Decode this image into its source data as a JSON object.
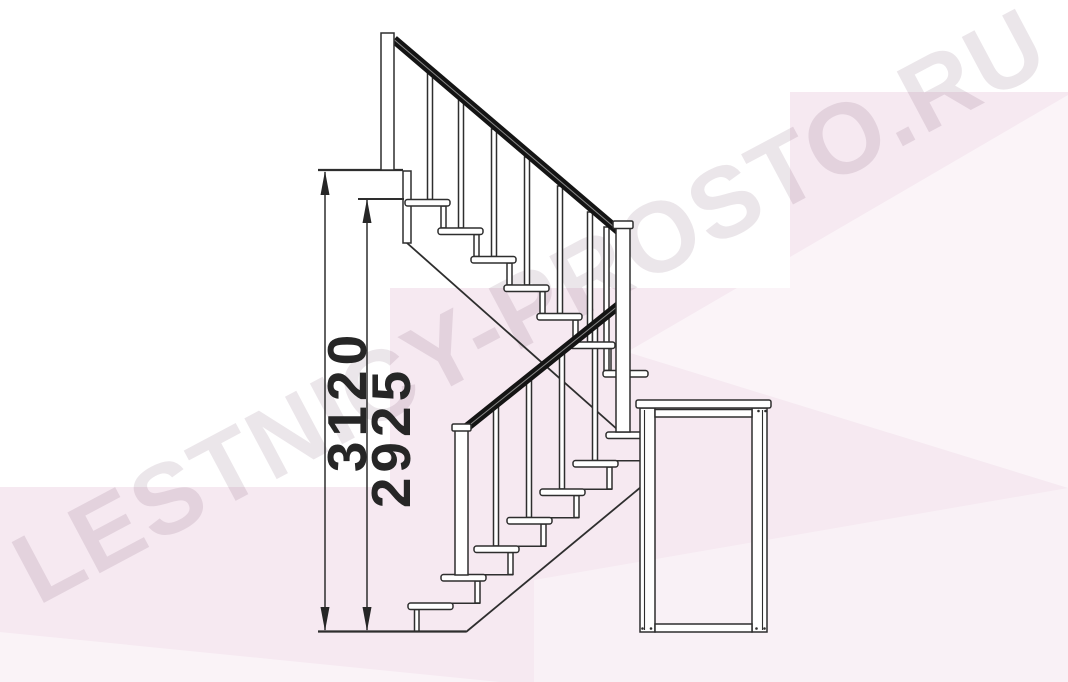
{
  "drawing": {
    "description": "Side elevation technical drawing of an L-shaped modular staircase: two flights of seven steps with black handrails and balusters, three newel posts, a landing platform on legs, ground line and vertical dimension lines",
    "upper_flight_steps": 7,
    "lower_flight_steps": 7,
    "colors": {
      "line": "#2e2e2e",
      "handrail": "#141414",
      "fill": "#ffffff"
    }
  },
  "dimensions": {
    "outer": {
      "label": "3120"
    },
    "inner": {
      "label": "2925"
    }
  },
  "watermark": {
    "text": "LESTNICY-PROSTO.RU",
    "color": "#e9e1e8"
  },
  "background": {
    "pink": "#f6e9f1",
    "white": "#ffffff"
  }
}
